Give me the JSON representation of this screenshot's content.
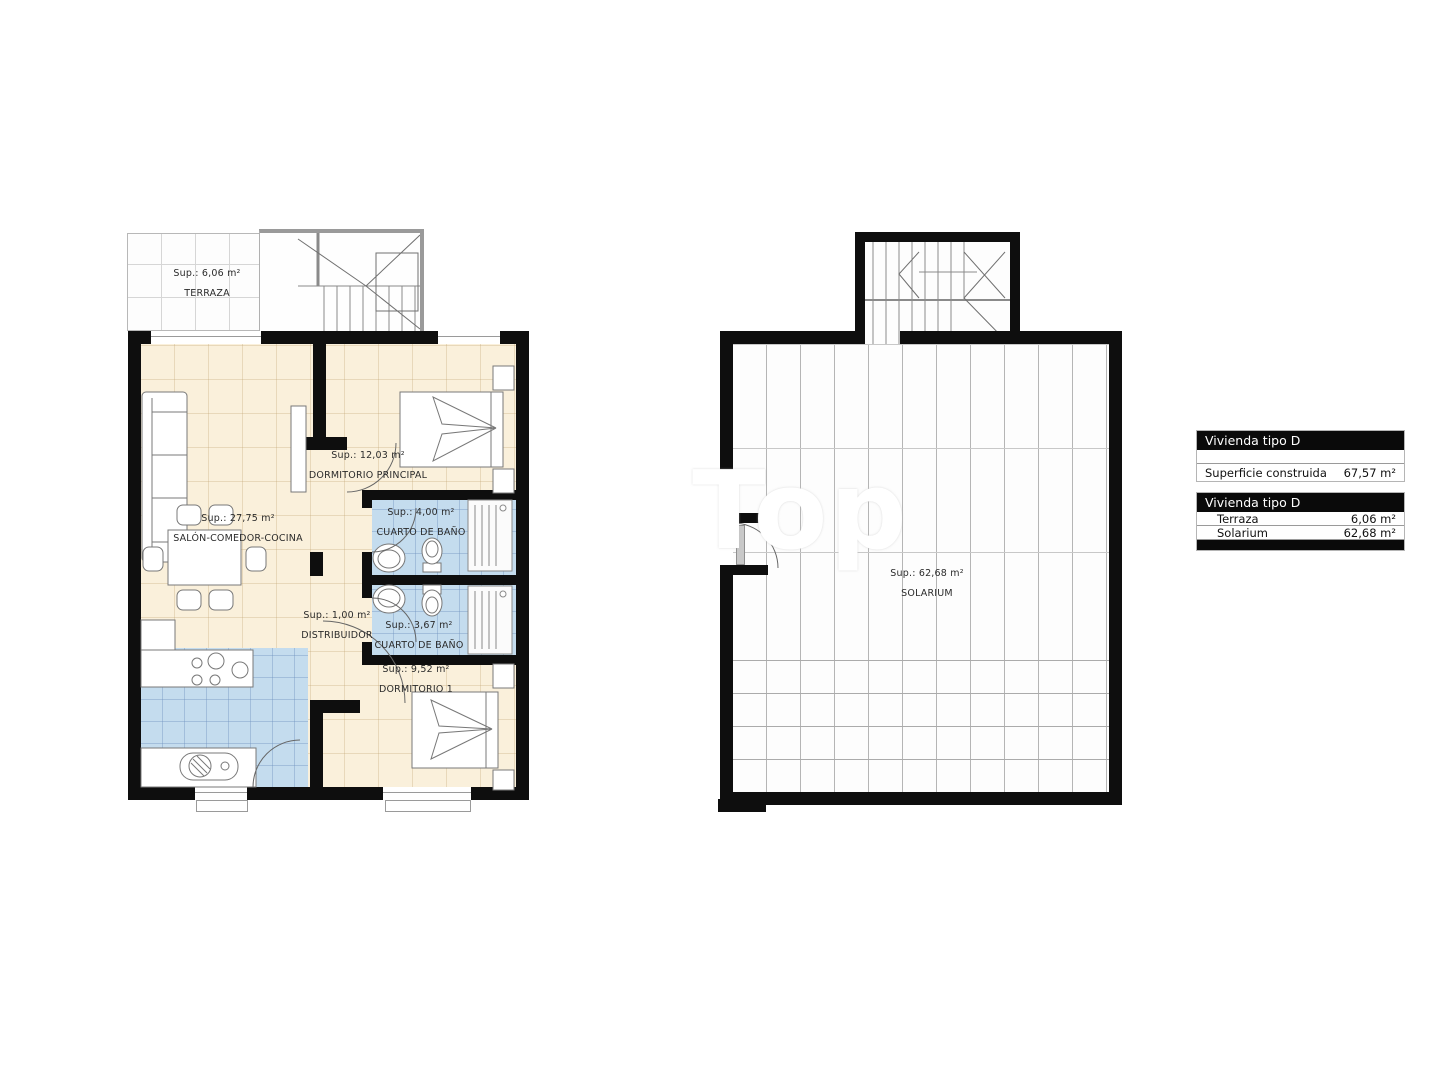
{
  "colors": {
    "wall": "#0e0e0e",
    "room_cream": "#faf0db",
    "wet_room_blue": "#c4dcee",
    "grid_light": "#d6d6d6",
    "grid_solarium": "#b5b5b5",
    "legend_header_bg": "#0a0a0a",
    "legend_header_text": "#ffffff"
  },
  "plans": {
    "floor": {
      "rooms": [
        {
          "id": "terraza",
          "area_label": "Sup.: 6,06 m²",
          "name_label": "TERRAZA"
        },
        {
          "id": "salon-comedor-cocina",
          "area_label": "Sup.: 27,75 m²",
          "name_label": "SALÓN-COMEDOR-COCINA"
        },
        {
          "id": "dormitorio-principal",
          "area_label": "Sup.: 12,03 m²",
          "name_label": "DORMITORIO PRINCIPAL"
        },
        {
          "id": "cuarto-de-bano-1",
          "area_label": "Sup.: 4,00 m²",
          "name_label": "CUARTO DE BAÑO"
        },
        {
          "id": "distribuidor",
          "area_label": "Sup.: 1,00 m²",
          "name_label": "DISTRIBUIDOR"
        },
        {
          "id": "cuarto-de-bano-2",
          "area_label": "Sup.: 3,67 m²",
          "name_label": "CUARTO DE BAÑO"
        },
        {
          "id": "dormitorio-1",
          "area_label": "Sup.: 9,52 m²",
          "name_label": "DORMITORIO 1"
        }
      ]
    },
    "roof": {
      "rooms": [
        {
          "id": "solarium",
          "area_label": "Sup.: 62,68 m²",
          "name_label": "SOLARIUM"
        }
      ]
    }
  },
  "legend": {
    "table1": {
      "title": "Vivienda tipo D",
      "rows": [
        {
          "label": "Superficie construida",
          "value": "67,57 m²"
        }
      ]
    },
    "table2": {
      "title": "Vivienda tipo D",
      "rows": [
        {
          "label": "Terraza",
          "value": "6,06 m²"
        },
        {
          "label": "Solarium",
          "value": "62,68 m²"
        }
      ]
    }
  },
  "watermark": {
    "text": "Top"
  }
}
